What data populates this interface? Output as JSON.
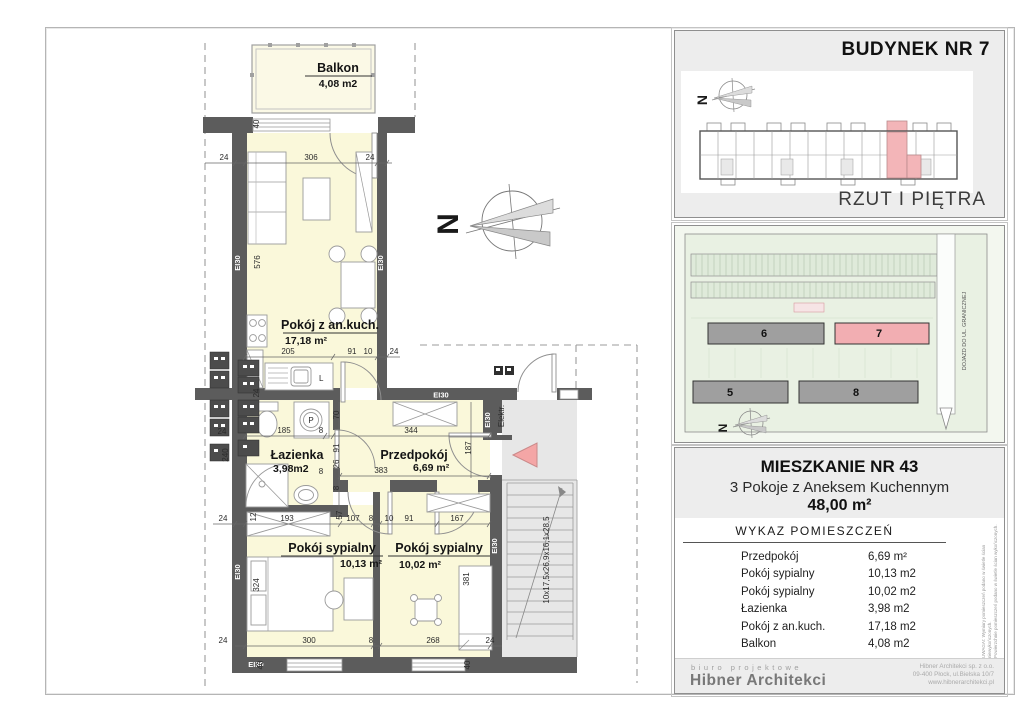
{
  "plan": {
    "fire_label": "EI30",
    "compass_letter": "N",
    "stair_note": "10x17,5x26,9x16,1x28,5",
    "elektr_label": "Elektr.",
    "kitchen_sink_label": "L",
    "washer_label": "P",
    "rooms": {
      "balkon": {
        "name": "Balkon",
        "area": "4,08 m2"
      },
      "living": {
        "name": "Pokój z an.kuch.",
        "area": "17,18 m²"
      },
      "lazienka": {
        "name": "Łazienka",
        "area": "3,98m2"
      },
      "przedpokoj": {
        "name": "Przedpokój",
        "area": "6,69 m²"
      },
      "sypialny1": {
        "name": "Pokój sypialny",
        "area": "10,13 m²"
      },
      "sypialny2": {
        "name": "Pokój sypialny",
        "area": "10,02 m²"
      }
    },
    "dims": {
      "top": [
        "24",
        "306",
        "24"
      ],
      "kitchen": [
        "205",
        "91",
        "10",
        "24"
      ],
      "mid": [
        "185",
        "8",
        "344"
      ],
      "hall": [
        "8",
        "383"
      ],
      "row": [
        "24",
        "12",
        "193",
        "107",
        "8",
        "10",
        "91",
        "167"
      ],
      "bottom": [
        "24",
        "300",
        "8",
        "268",
        "24"
      ],
      "v": {
        "balcony_wall": "40",
        "living": "576",
        "pass": "70",
        "d91": "91",
        "d26": "26",
        "d8": "8",
        "d57": "57",
        "hall_depth": "187",
        "bath": "240",
        "wall24a": "24",
        "wall24b": "24",
        "bed1": "324",
        "bed2": "381",
        "sill40a": "40",
        "sill40b": "40"
      }
    }
  },
  "panel": {
    "budynek": "BUDYNEK NR 7",
    "rzut": "RZUT I PIĘTRA",
    "site": {
      "labels": [
        "6",
        "7",
        "5",
        "8"
      ],
      "road": "DOJAZD DO UL. GRANICZNEJ"
    },
    "apt": {
      "title": "MIESZKANIE NR 43",
      "subtitle": "3 Pokoje z Aneksem Kuchennym",
      "area": "48,00 m²"
    },
    "wykaz": {
      "title": "WYKAZ POMIESZCZEŃ",
      "rows": [
        {
          "name": "Przedpokój",
          "area": "6,69 m²"
        },
        {
          "name": "Pokój sypialny",
          "area": "10,13 m2"
        },
        {
          "name": "Pokój sypialny",
          "area": "10,02 m2"
        },
        {
          "name": "Łazienka",
          "area": "3,98 m2"
        },
        {
          "name": "Pokój z an.kuch.",
          "area": "17,18 m2"
        },
        {
          "name": "Balkon",
          "area": "4,08 m2"
        }
      ]
    },
    "disclaimer": [
      "UWAGA!: Wymiary pomieszczeń podano w świetle ścian niewykończonych.",
      "Powierzchnie pomieszczeń podano w świetle ścian wykończonych."
    ],
    "footer": {
      "tagline": "biuro projektowe",
      "studio": "Hibner Architekci",
      "lines": [
        "Hibner Architekci sp. z o.o.",
        "09-400 Płock, ul.Bielska 10/7",
        "www.hibnerarchitekci.pl"
      ]
    }
  }
}
